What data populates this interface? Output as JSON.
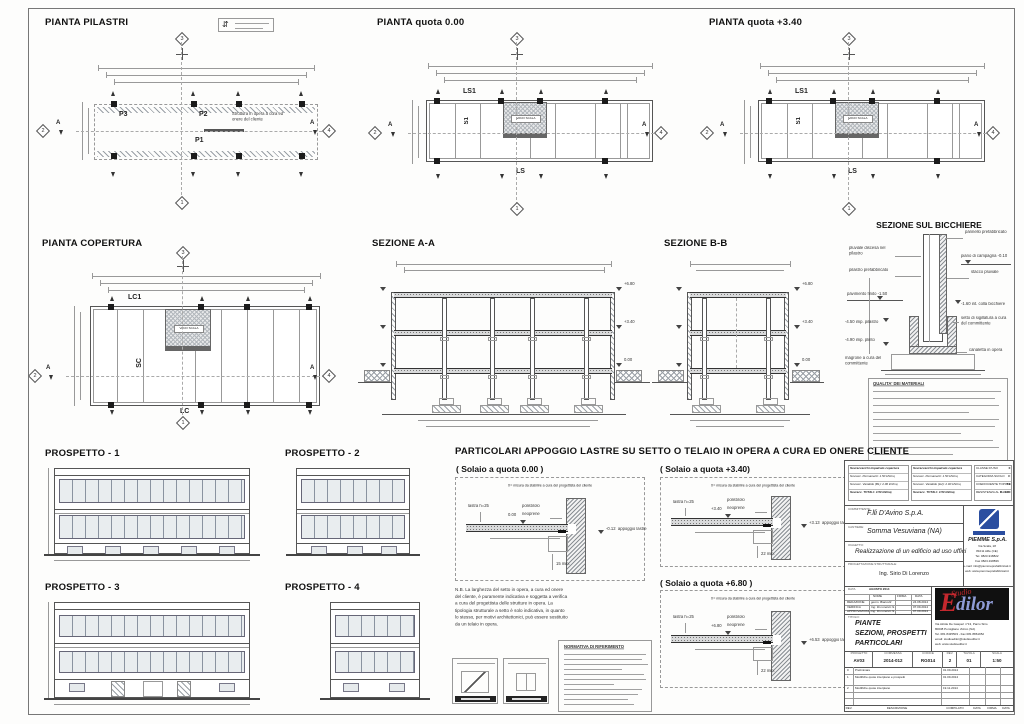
{
  "colors": {
    "line": "#555555",
    "accent_red": "#c4282e",
    "accent_blue": "#2b4ea0"
  },
  "plans": {
    "pilastri": {
      "title": "PIANTA PILASTRI",
      "p3": "P3",
      "p2": "P2",
      "p1": "P1",
      "note": "Struttura in opera a cura ed onere del cliente",
      "m_top": "3",
      "m_left": "2",
      "m_right": "4",
      "m_bottom": "1",
      "sec": "A"
    },
    "q000": {
      "title": "PIANTA quota 0.00",
      "ls1": "LS1",
      "s1": "S1",
      "ls": "LS",
      "vano": "VANO SCALA",
      "m_top": "3",
      "m_left": "2",
      "m_right": "4",
      "m_bottom": "1",
      "sec": "A"
    },
    "q340": {
      "title": "PIANTA quota +3.40",
      "ls1": "LS1",
      "s1": "S1",
      "ls": "LS",
      "vano": "VANO SCALA",
      "m_top": "3",
      "m_left": "2",
      "m_right": "4",
      "m_bottom": "1",
      "sec": "A"
    },
    "copertura": {
      "title": "PIANTA COPERTURA",
      "lc1": "LC1",
      "sc": "SC",
      "lc": "LC",
      "vano": "VANO SCALA",
      "m_top": "3",
      "m_left": "2",
      "m_right": "4",
      "m_bottom": "1",
      "sec": "A"
    }
  },
  "sections": {
    "aa": {
      "title": "SEZIONE A-A",
      "lv1": "+6.80",
      "lv2": "+3.40",
      "lv3": "0.00"
    },
    "bb": {
      "title": "SEZIONE B-B",
      "lv1": "+6.80",
      "lv2": "+3.40",
      "lv3": "0.00"
    },
    "bicchiere": {
      "title": "SEZIONE SUL BICCHIERE",
      "pannello": "pannello prefabbricato",
      "campagna": "piano di campagna -0.10",
      "pluviale": "pluviale discesa nel pilastro",
      "stacco": "stacco pluviale",
      "pilastro": "pilastro prefabbricato",
      "pavimento": "pavimento finito -1.50",
      "colla": "-1.60 int. colla bicchiere",
      "imp_pilastro": "-4.50 imp. pilastro",
      "imp_plinto": "-4.90 imp. plinto",
      "setto": "setto di sigillatura a cura del committente",
      "canaletta": "canaletta in opera",
      "magrone": "magrone a cura del committente"
    }
  },
  "note_materiali": {
    "title": "QUALITA' DEI MATERIALI"
  },
  "prospetti": {
    "p1": "PROSPETTO - 1",
    "p2": "PROSPETTO - 2",
    "p3": "PROSPETTO - 3",
    "p4": "PROSPETTO - 4"
  },
  "particolari": {
    "heading": "PARTICOLARI APPOGGIO LASTRE SU SETTO O TELAIO IN OPERA A CURA ED ONERE CLIENTE",
    "x_note": "X= misura da stabilire a cura del progettista del cliente",
    "lastra": "lastra h=25",
    "polistirolo": "polistirolo",
    "neoprene": "neoprene",
    "appoggio": "appoggio lastre",
    "d000": {
      "label": "( Solaio a quota 0.00 )",
      "q_top": "0.00",
      "q_app": "-0.12",
      "min": "15 min."
    },
    "d340": {
      "label": "( Solaio a quota +3.40)",
      "q_top": "+3.40",
      "q_app": "+3.13",
      "min": "22 min."
    },
    "d680": {
      "label": "( Solaio a quota +6.80 )",
      "q_top": "+6.80",
      "q_app": "+6.53",
      "min": "22 min."
    },
    "nb": "N.B. La larghezza del setto in opera, a cura ed onere del cliente, è puramente indicativa e soggetta a verifica a cura del progettista delle strutture in opera. La tipologia strutturale a setto è solo indicativa, in quanto lo stesso, per motivi architettonici, può essere sostituito da un telaio in opera.",
    "normativa": "NORMATIVA DI RIFERIMENTO"
  },
  "titleblock": {
    "loads1": {
      "title": "Sovraccarichi impalcato copertura",
      "r1": "Sovracc. Permanenti:  1.50 kN/mq",
      "r2": "Sovracc. Variabile (B1):  2.00 kN/mq",
      "r3": "Sovracc. TOTALI:  3.50 kN/mq"
    },
    "loads2": {
      "title": "Sovraccarichi impalcato copertura",
      "r1": "Sovracc. Permanenti:  1.50 kN/mq",
      "r2": "Sovracc. Variabile (H2):  2.00 kN/mq",
      "r3": "Sovracc. TOTALI:  3.50 kN/mq"
    },
    "classe": {
      "l1": "CLASSE D'USO",
      "v1": "II",
      "l2": "CATEGORIA SUOLO",
      "v2": "C",
      "l3": "COEFFICIENTE TOPOGRAFICO",
      "v3": "T1",
      "l4": "RESISTENZA AL FUOCO",
      "v4": "R - 120"
    },
    "committente_l": "COMMITTENTE:",
    "committente": "F.lli D'Avino S.p.A.",
    "cantiere_l": "CANTIERE:",
    "cantiere": "Somma Vesuviana (NA)",
    "oggetto_l": "OGGETTO:",
    "oggetto": "Realizzazione di un edificio ad uso uffici",
    "prog_l": "PROGETTAZIONE STRUTTURALE:",
    "prog": "Ing. Sirio Di Lorenzo",
    "data_l": "DATA",
    "data_v": "AGOSTO 2014",
    "sig_h": [
      "NOME",
      "FIRMA",
      "DATA"
    ],
    "sig": [
      [
        "REDAZIONE",
        "geom. Bianculli",
        "24.08.2014"
      ],
      [
        "VERIFICA",
        "Ing. Di Lorenzo S.",
        "07.09.2014"
      ],
      [
        "APPROVAZIONE",
        "Ing. Di Lorenzo S.",
        "07.09.2014"
      ]
    ],
    "titolo_l": "TITOLO:",
    "titolo": [
      "PIANTE",
      "SEZIONI, PROSPETTI",
      "PARTICOLARI"
    ],
    "piemme": {
      "name": "PIEMME S.p.A.",
      "a1": "Via Scafa, 18",
      "a2": "81011 Alife (CE)",
      "a3": "Tel. 0823-918822",
      "a4": "Fax 0823-918836",
      "a5": "e-mail: info@piemmeprefabbricati.it",
      "a6": "web: www.piemmeprefabbricati.it"
    },
    "edilor": {
      "studio": "Studio",
      "e": "E",
      "rest": "dilor",
      "a1": "Via Alcide De Gasperi n°13, Parco Sirio",
      "a2": "80038 Pomigliano d'Arco (NA)",
      "a3": "Tel. 081 8435503 - Fax 081 8861952",
      "a4": "email: studioedilor@studioedilor.it",
      "a5": "web: www.studioedilor.it"
    },
    "codes": {
      "l": [
        "PROGETTO",
        "COMMESSA",
        "CODICE",
        "REV.",
        "TAVOLA",
        "SCALA"
      ],
      "v": [
        "AV03",
        "2014-012",
        "RG014",
        "2",
        "01",
        "1:50"
      ]
    },
    "rev": [
      [
        "0",
        "Preliminare",
        "01.09.2014"
      ],
      [
        "1",
        "Modifiche quote interpiano e prospetti",
        "01.09.2014"
      ],
      [
        "2",
        "Modifiche quote interpiano",
        "19.11.2014"
      ]
    ],
    "footer": [
      "REV.",
      "DESCRIZIONE",
      "COMPILATO",
      "DATA",
      "FIRMA",
      "DATA"
    ]
  }
}
